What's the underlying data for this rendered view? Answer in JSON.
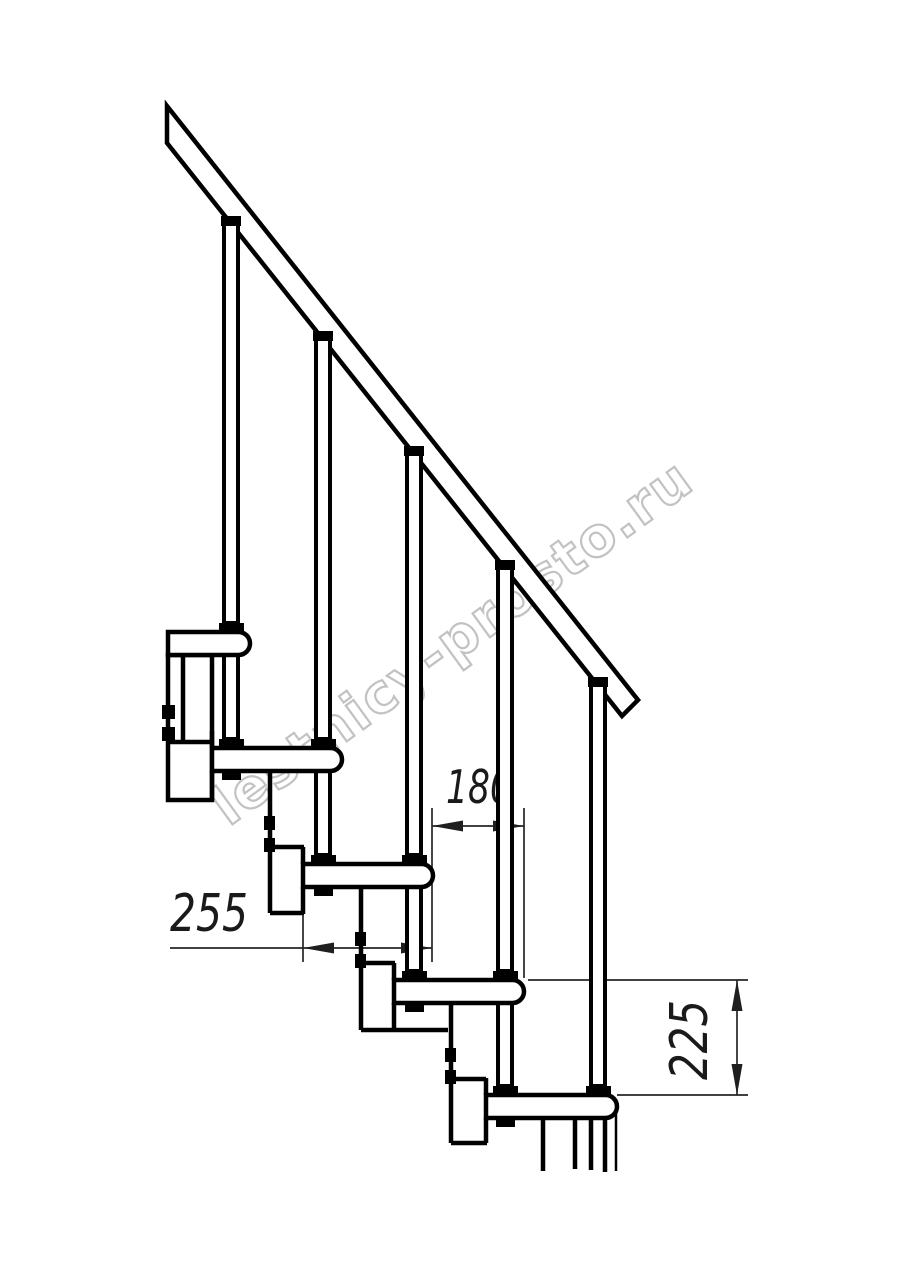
{
  "drawing": {
    "subject": "modular staircase side elevation fragment",
    "treads_visible": 5,
    "balusters_visible": 5,
    "dimensions": {
      "step_run": {
        "value": "180",
        "orientation": "horizontal"
      },
      "tread_depth": {
        "value": "255",
        "orientation": "horizontal"
      },
      "step_rise": {
        "value": "225",
        "orientation": "vertical"
      }
    },
    "colors": {
      "line": "#000000",
      "dimension_line": "#262626",
      "background": "#ffffff",
      "watermark": "#ababab"
    }
  },
  "watermark": {
    "text": "lestnicy-prosto.ru"
  }
}
